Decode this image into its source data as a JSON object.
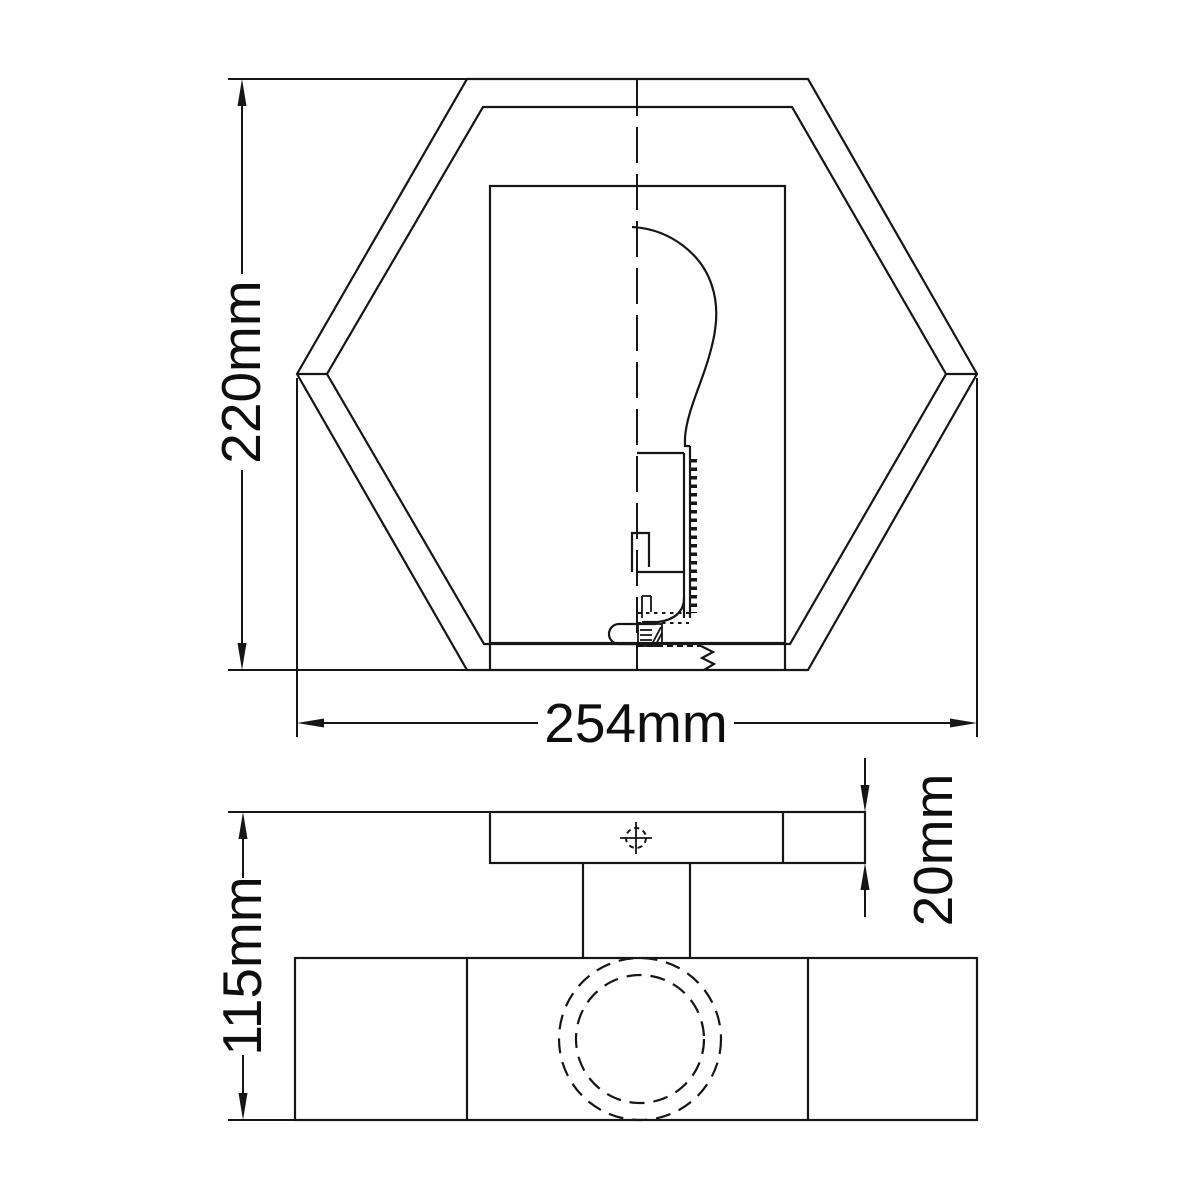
{
  "drawing": {
    "background_color": "#ffffff",
    "line_color": "#161616",
    "views": {
      "front": {
        "height_dimension": "220mm",
        "width_dimension": "254mm"
      },
      "side": {
        "height_dimension": "115mm",
        "plate_thickness_dimension": "20mm"
      }
    }
  }
}
